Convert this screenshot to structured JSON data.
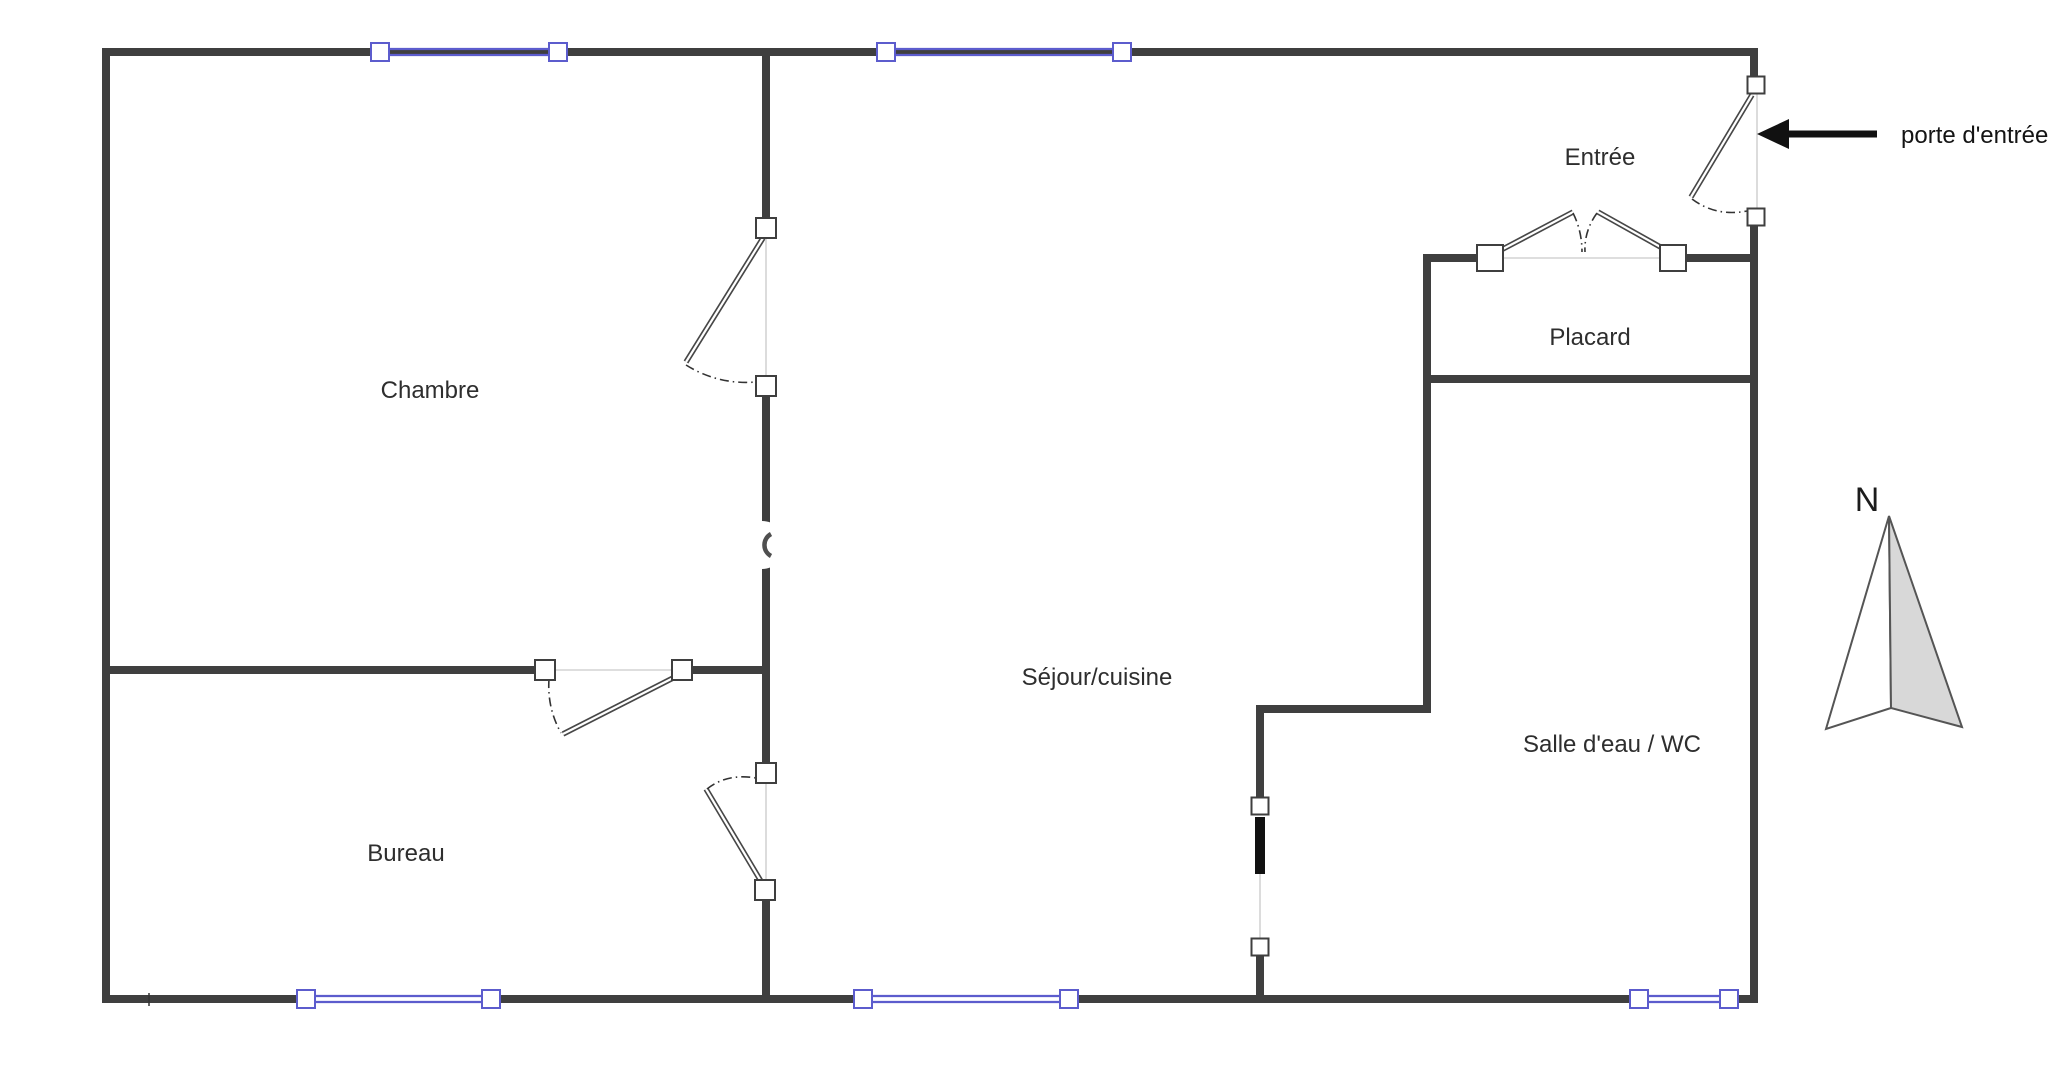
{
  "labels": {
    "chambre": "Chambre",
    "bureau": "Bureau",
    "sejour_cuisine": "Séjour/cuisine",
    "salle_eau_wc": "Salle d'eau / WC",
    "entree": "Entrée",
    "placard": "Placard"
  },
  "annotations": {
    "entrance_door_label": "porte d'entrée",
    "compass_north": "N"
  },
  "colors": {
    "wall": "#3f3f3f",
    "window": "#5c5ccd",
    "door-line": "#474747",
    "swing": "#333333",
    "opening": "#c9c9c9",
    "text": "#2e2e2e",
    "arrow": "#111111",
    "compass-fill": "#d8d8d8",
    "compass-stroke": "#555555",
    "sliding-door": "#111111",
    "background": "#ffffff"
  }
}
